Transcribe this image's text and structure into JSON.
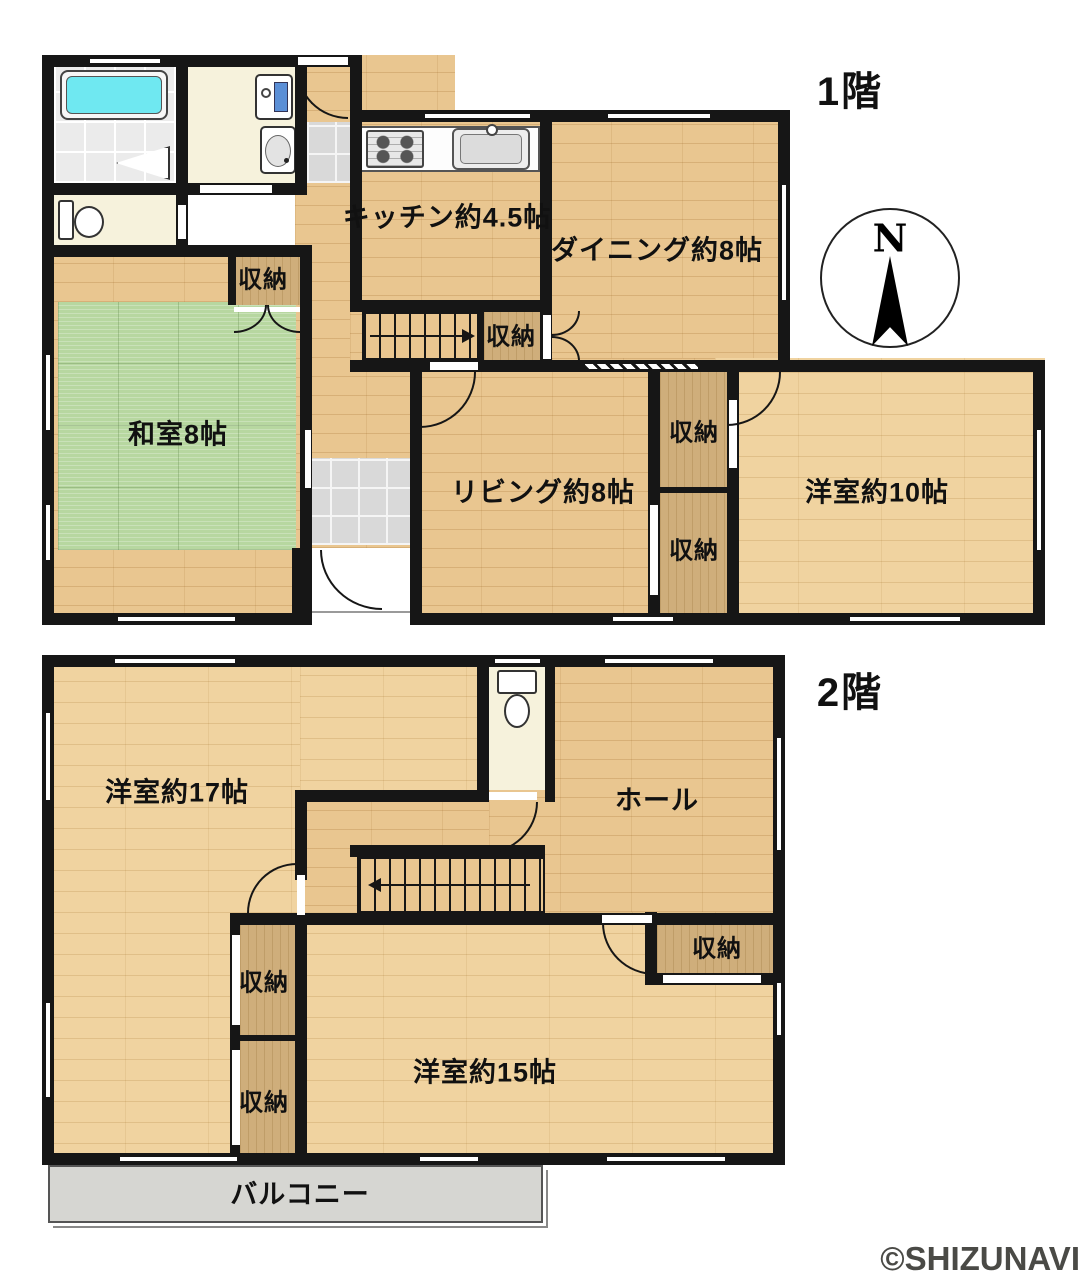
{
  "floor1": {
    "title": "1階",
    "kitchen": "キッチン約4.5帖",
    "dining": "ダイニング約8帖",
    "japanese_room": "和室8帖",
    "living": "リビング約8帖",
    "western_room_10": "洋室約10帖",
    "storage": "収納"
  },
  "floor2": {
    "title": "2階",
    "western_room_17": "洋室約17帖",
    "hall": "ホール",
    "western_room_15": "洋室約15帖",
    "balcony": "バルコニー",
    "storage": "収納"
  },
  "compass": {
    "north_label": "N"
  },
  "watermark": "©SHIZUNAVI",
  "colors": {
    "wall": "#161616",
    "wood": "#e9c690",
    "wood_light": "#f0d3a0",
    "tatami": "#b7d7a0",
    "storage": "#cfae7b",
    "cream": "#f6f2dc",
    "tile": "#d9d9d9",
    "balcony": "#d6d6d2",
    "tub": "#6fe8f1",
    "washer_blue": "#5b8fd6",
    "text": "#111111",
    "watermark_color": "#4a4a46"
  }
}
